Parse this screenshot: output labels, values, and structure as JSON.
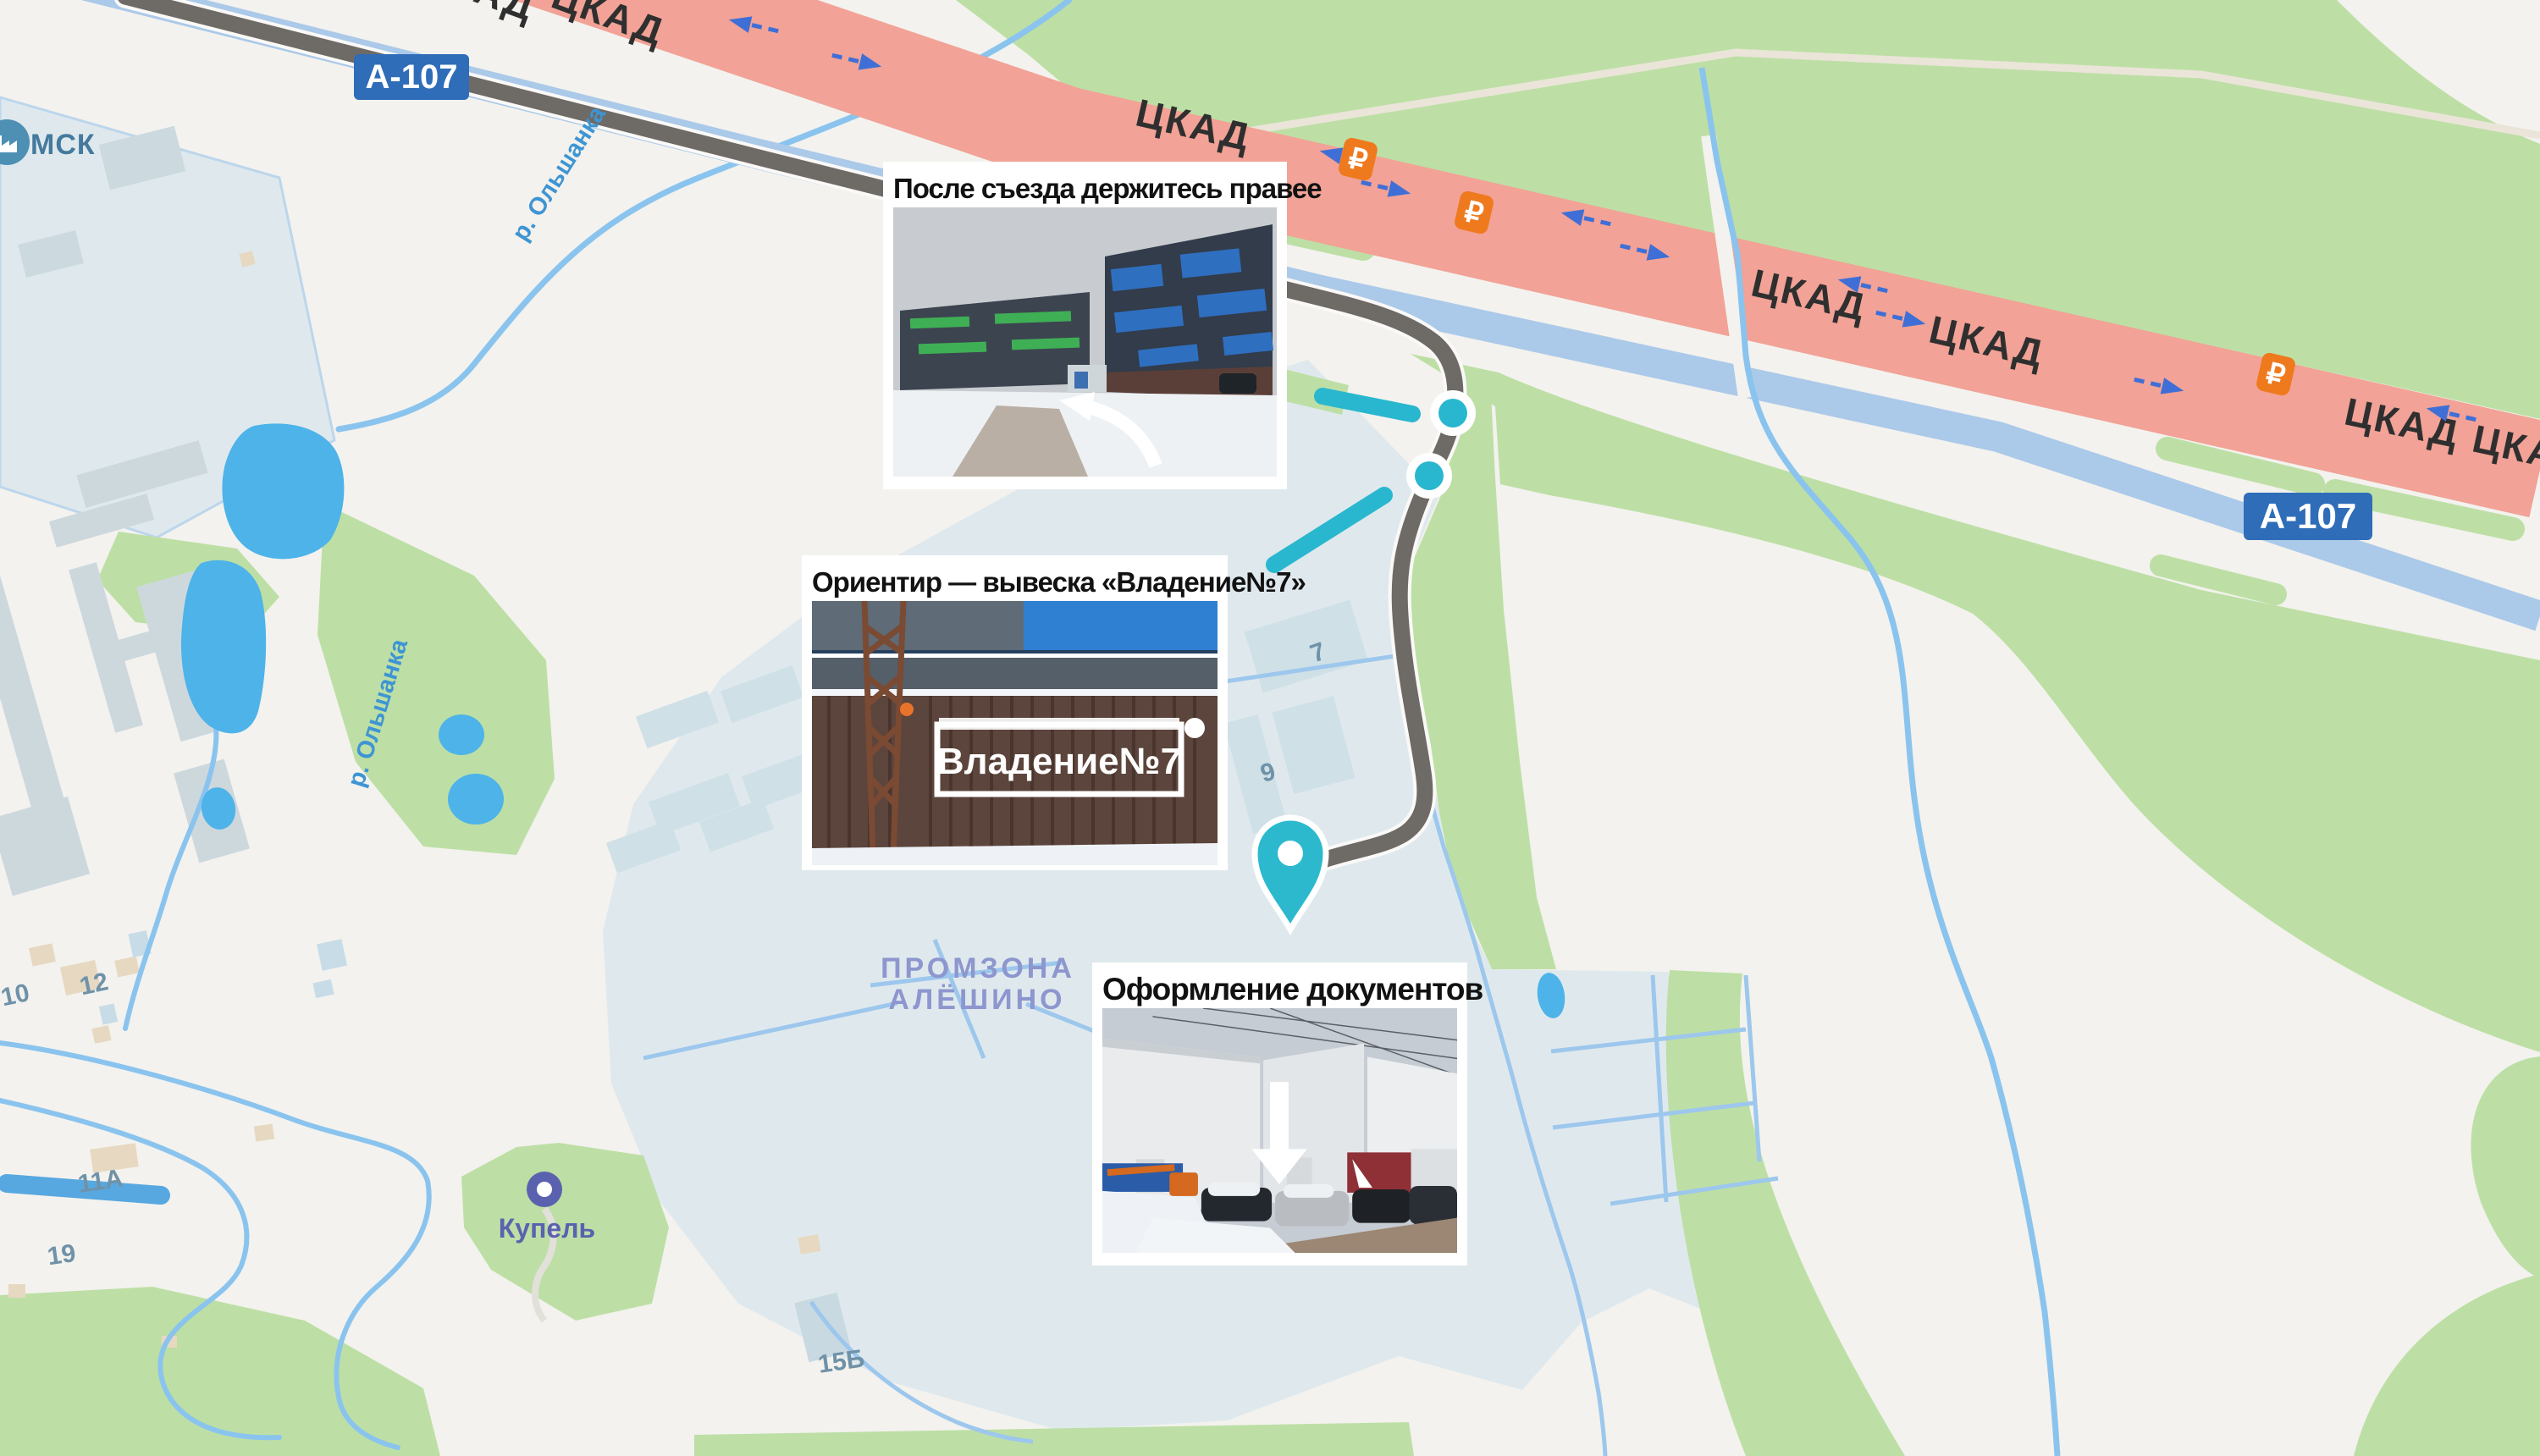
{
  "map": {
    "city_label": "МСК",
    "road_badges": [
      {
        "label": "А-107"
      },
      {
        "label": "А-107"
      }
    ],
    "highway_labels": [
      "ЦКАД",
      "ЦКАД",
      "ЦКАД",
      "ЦКАД",
      "ЦКАД",
      "ЦКАД",
      "ЦКАД"
    ],
    "toll_symbol": "₽",
    "river_labels": [
      "р. Ольшанка",
      "р. Ольшанка"
    ],
    "industrial_zone_label": {
      "line1": "ПРОМЗОНА",
      "line2": "АЛЁШИНО"
    },
    "poi_label": "Купель",
    "building_numbers": [
      "7",
      "9",
      "10",
      "12",
      "11А",
      "19",
      "15Б"
    ],
    "colors": {
      "accent_teal": "#29b7cf",
      "route_gray": "#6e6a66",
      "toll_road_salmon": "#f2a296",
      "highway_blue_band": "#abc9e9",
      "badge_blue": "#2f6db8",
      "toll_badge_orange": "#ef7a1e",
      "water_blue": "#4db3e9",
      "green_area": "#bddfa5",
      "industrial_zone": "#dfe9ed"
    }
  },
  "callouts": [
    {
      "caption": "После съезда держитесь правее"
    },
    {
      "caption": "Ориентир — вывеска «Владение№7»",
      "sign_text": "Владение№7"
    },
    {
      "caption": "Оформление документов"
    }
  ]
}
